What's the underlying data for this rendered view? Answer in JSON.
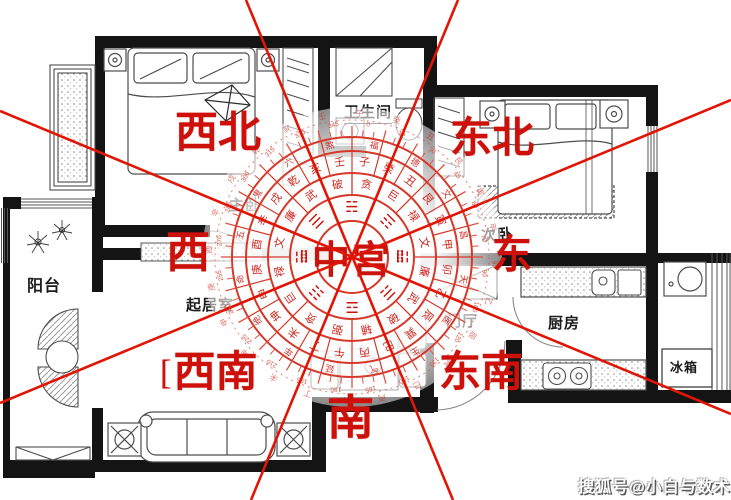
{
  "watermark": {
    "text": "搜狐号@小白与数术"
  },
  "directions": {
    "northwest": "西北",
    "northeast": "东北",
    "west": "西",
    "east": "东",
    "center": "中宫",
    "southwest": "西南",
    "southeast": "东南",
    "south": "南",
    "southwest_bracket": "["
  },
  "rooms": {
    "master_bedroom": "主卧",
    "bathroom": "卫生间",
    "second_bedroom": "次卧",
    "balcony": "阳台",
    "living_room": "起居室",
    "entry_hall": "门厅",
    "kitchen": "厨房",
    "fridge": "冰箱"
  },
  "compass": {
    "center_label": "中宫",
    "side_mark": "⣿",
    "trigrams": [
      "☵",
      "☶",
      "☳",
      "☴",
      "☲",
      "☷",
      "☱",
      "☰"
    ],
    "ring_stars": [
      "贪",
      "巨",
      "禄",
      "文",
      "廉",
      "武",
      "破",
      "辅",
      "弼",
      "贪",
      "巨",
      "禄",
      "文",
      "廉",
      "武",
      "破"
    ],
    "ring_mountains": [
      "子",
      "癸",
      "丑",
      "艮",
      "寅",
      "甲",
      "卯",
      "乙",
      "辰",
      "巽",
      "巳",
      "丙",
      "午",
      "丁",
      "未",
      "坤",
      "申",
      "庚",
      "酉",
      "辛",
      "戌",
      "乾",
      "亥",
      "壬"
    ],
    "ring_outer": [
      "福",
      "德",
      "文",
      "昌",
      "天",
      "医",
      "生",
      "气",
      "延",
      "年",
      "绝",
      "命",
      "五",
      "鬼",
      "六",
      "煞"
    ],
    "degree_step": 15,
    "colors": {
      "ring": "#d6382a",
      "glyph": "#cb120b",
      "tick": "#dd5244"
    }
  },
  "colors": {
    "wall": "#141414",
    "line_red": "#e11505",
    "label_red": "#cd100a"
  }
}
